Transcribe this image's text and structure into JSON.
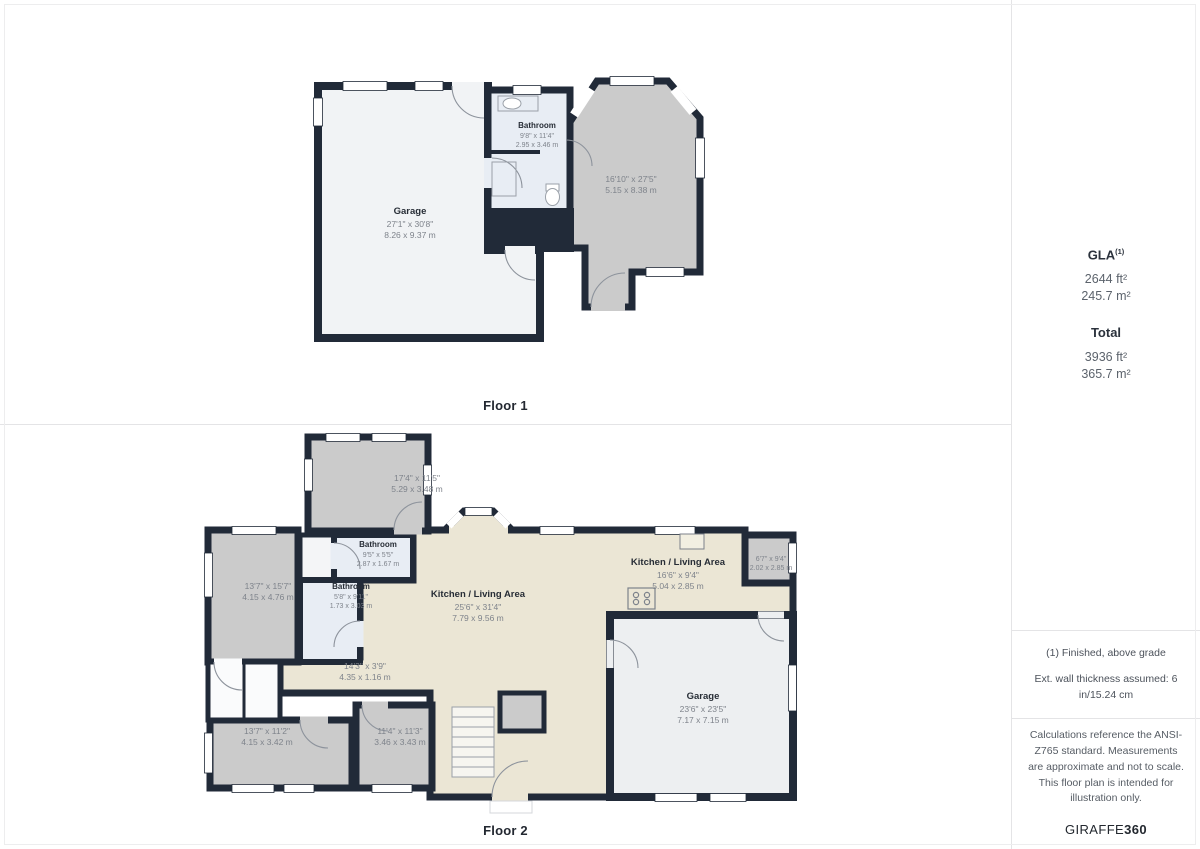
{
  "floor1": {
    "caption": "Floor 1",
    "rooms": {
      "garage": {
        "name": "Garage",
        "imperial": "27'1\" x 30'8\"",
        "metric": "8.26 x 9.37 m"
      },
      "bathroom": {
        "name": "Bathroom",
        "imperial": "9'8\" x 11'4\"",
        "metric": "2.95 x 3.46 m"
      },
      "right_room": {
        "name": "",
        "imperial": "16'10\" x 27'5\"",
        "metric": "5.15 x 8.38 m"
      }
    }
  },
  "floor2": {
    "caption": "Floor 2",
    "rooms": {
      "top_room": {
        "name": "",
        "imperial": "17'4\" x 11'5\"",
        "metric": "5.29 x 3.48 m"
      },
      "left_room": {
        "name": "",
        "imperial": "13'7\" x 15'7\"",
        "metric": "4.15 x 4.76 m"
      },
      "bathroom_top": {
        "name": "Bathroom",
        "imperial": "9'5\" x 5'5\"",
        "metric": "2.87 x 1.67 m"
      },
      "bathroom_mid": {
        "name": "Bathroom",
        "imperial": "5'8\" x 9'11\"",
        "metric": "1.73 x 3.03 m"
      },
      "kitchen_main": {
        "name": "Kitchen / Living Area",
        "imperial": "25'6\" x 31'4\"",
        "metric": "7.79 x 9.56 m"
      },
      "kitchen_right": {
        "name": "Kitchen / Living Area",
        "imperial": "16'6\" x 9'4\"",
        "metric": "5.04 x 2.85 m"
      },
      "small_room": {
        "name": "",
        "imperial": "6'7\" x 9'4\"",
        "metric": "2.02 x 2.85 m"
      },
      "hallway": {
        "name": "",
        "imperial": "14'3\" x 3'9\"",
        "metric": "4.35 x 1.16 m"
      },
      "bottom_left_room": {
        "name": "",
        "imperial": "13'7\" x 11'2\"",
        "metric": "4.15 x 3.42 m"
      },
      "bottom_mid_room": {
        "name": "",
        "imperial": "11'4\" x 11'3\"",
        "metric": "3.46 x 3.43 m"
      },
      "garage": {
        "name": "Garage",
        "imperial": "23'6\" x 23'5\"",
        "metric": "7.17 x 7.15 m"
      }
    }
  },
  "sidebar": {
    "gla": {
      "label": "GLA",
      "superscript": "(1)",
      "sqft": "2644 ft²",
      "sqm": "245.7 m²"
    },
    "total": {
      "label": "Total",
      "sqft": "3936 ft²",
      "sqm": "365.7 m²"
    },
    "notes": {
      "note1": "(1) Finished, above grade",
      "note2": "Ext. wall thickness assumed: 6 in/15.24 cm"
    },
    "disclaimer": "Calculations reference the ANSI-Z765 standard. Measurements are approximate and not to scale. This floor plan is intended for illustration only.",
    "brand": {
      "name": "GIRAFFE",
      "suffix": "360"
    }
  },
  "colors": {
    "wall": "#212a38",
    "gray_room": "#cbcbcb",
    "cream_room": "#ebe6d5",
    "bath_room": "#e8edf4",
    "light_room": "#f1f3f5"
  }
}
